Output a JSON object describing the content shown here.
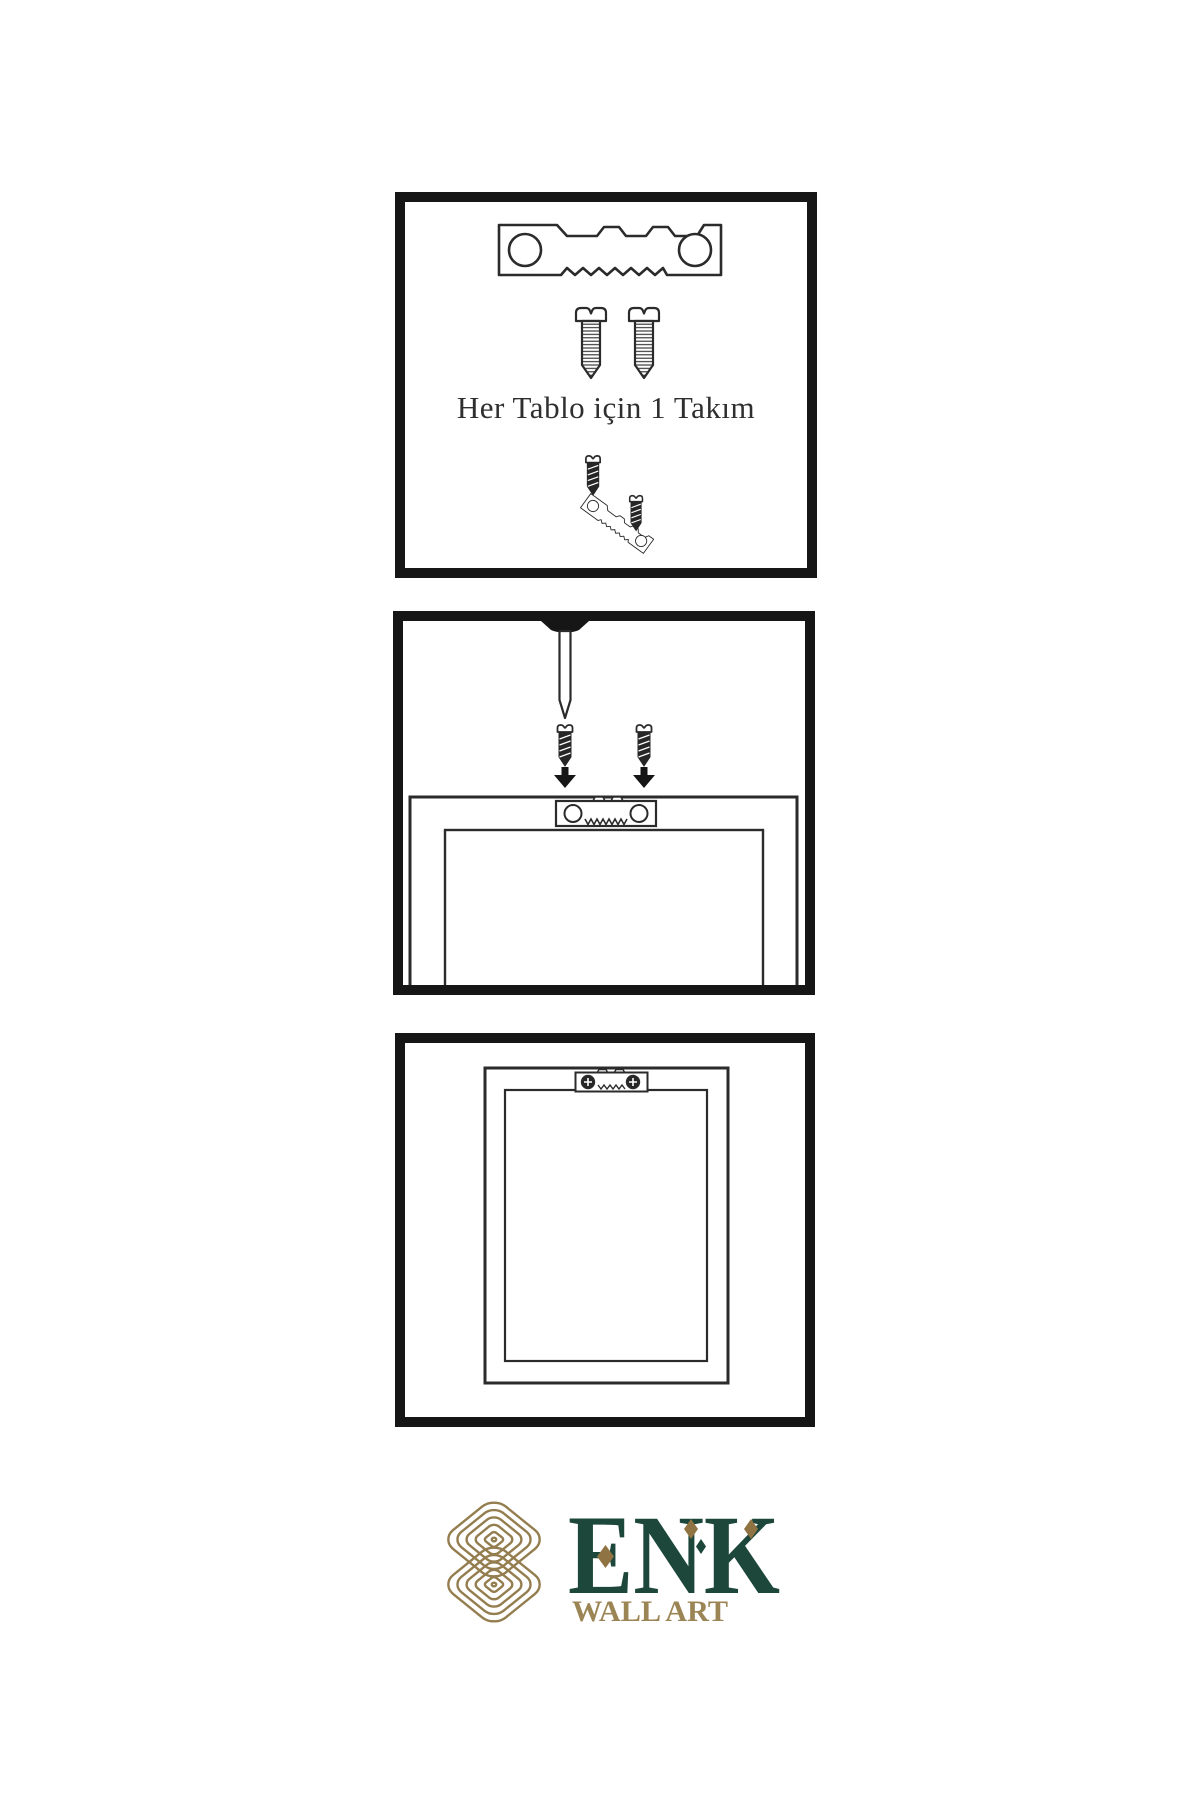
{
  "colors": {
    "background": "#ffffff",
    "line_art": "#2b2b2b",
    "panel_border": "#161616",
    "screw_fill": "#262626",
    "logo_gold": "#947d4e",
    "logo_green": "#1c473a",
    "diamond_gold": "#8f7342"
  },
  "panel1": {
    "caption": "Her Tablo için 1 Takım"
  },
  "logo": {
    "brand": "ENK",
    "tagline": "WALL ART"
  }
}
